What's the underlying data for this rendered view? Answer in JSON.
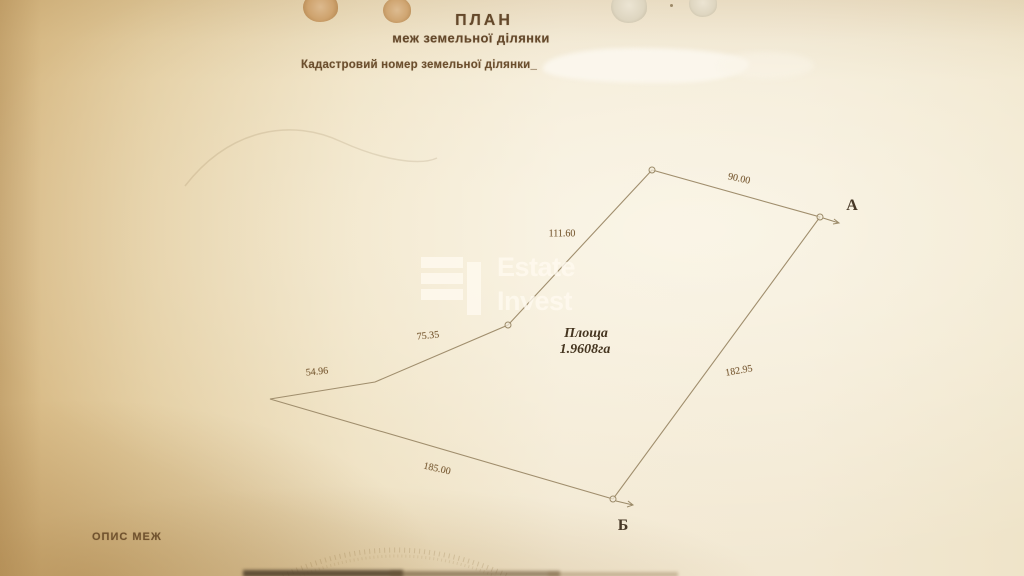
{
  "document": {
    "title_line1": "ПЛАН",
    "title_line2": "меж земельної ділянки",
    "cadastral_label": "Кадастровий номер земельної ділянки_",
    "section_footer": "ОПИС МЕЖ"
  },
  "watermark": {
    "brand_line1": "Estate",
    "brand_line2": "Invest"
  },
  "plan": {
    "area_label": "Площа",
    "area_value": "1.9608га",
    "points": {
      "a": "А",
      "b": "Б"
    },
    "measurements": {
      "top_edge": "90.00",
      "upper_left_edge": "111.60",
      "mid_left_edge": "75.35",
      "lower_left_edge": "54.96",
      "bottom_edge": "185.00",
      "right_edge": "182.95"
    }
  },
  "colors": {
    "paper_left": "#d9bd8a",
    "paper_center": "#f3ead7",
    "ink_brown": "#64482a",
    "measurement_ink": "#7a5c35",
    "boundary_line": "#a08e6d",
    "watermark_white": "rgba(255,250,239,0.78)"
  }
}
